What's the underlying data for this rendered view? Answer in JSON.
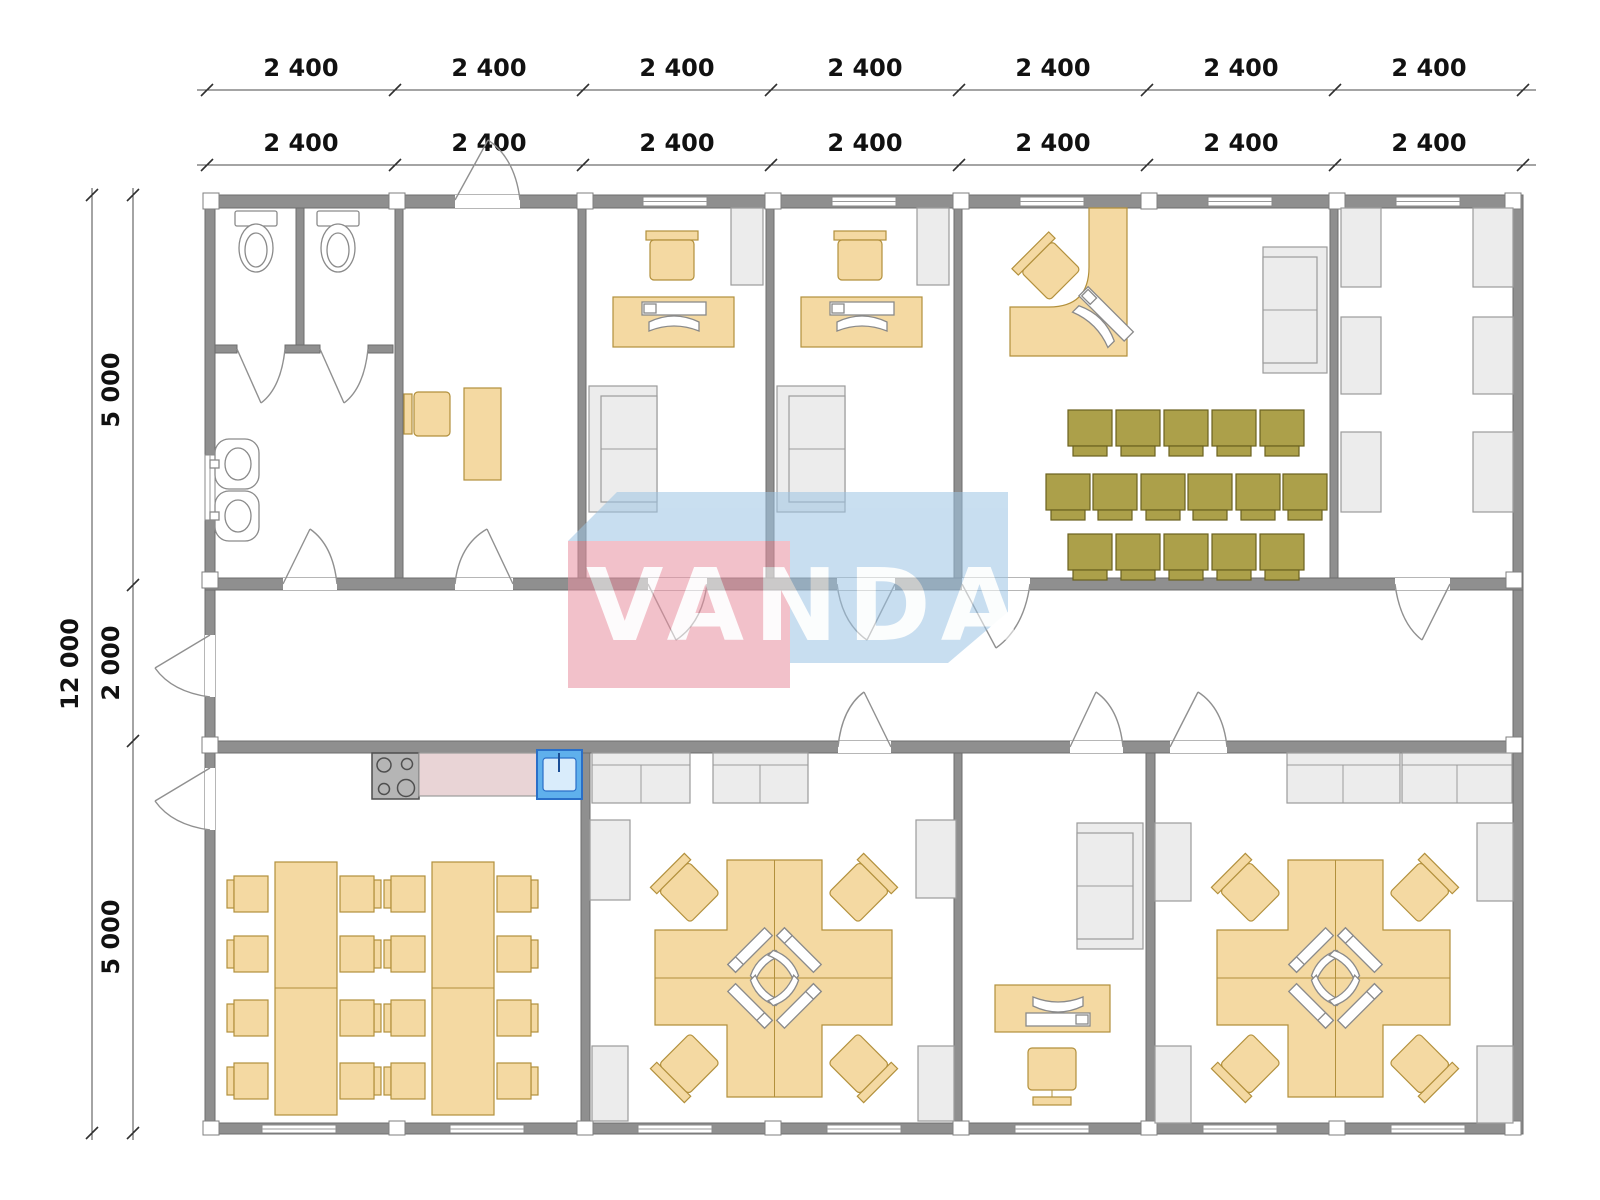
{
  "watermark": {
    "text": "VANDA",
    "pink": "#E98FA0",
    "blue": "#9CC4E4"
  },
  "dims": {
    "top_outer": [
      "2 400",
      "2 400",
      "2 400",
      "2 400",
      "2 400",
      "2 400",
      "2 400"
    ],
    "top_inner": [
      "2 400",
      "2 400",
      "2 400",
      "2 400",
      "2 400",
      "2 400",
      "2 400"
    ],
    "left_total": "12 000",
    "left_segs": [
      "5 000",
      "2 000",
      "5 000"
    ]
  },
  "colors": {
    "wall": "#8F8F8F",
    "wood_furniture": "#F4D9A2",
    "wood_border": "#B2903C",
    "audience_chair": "#ACA04A",
    "gray_furniture": "#ECECEC",
    "kitchen_counter": "#E9D4D6",
    "kitchen_sink": "#5FB0EC"
  }
}
